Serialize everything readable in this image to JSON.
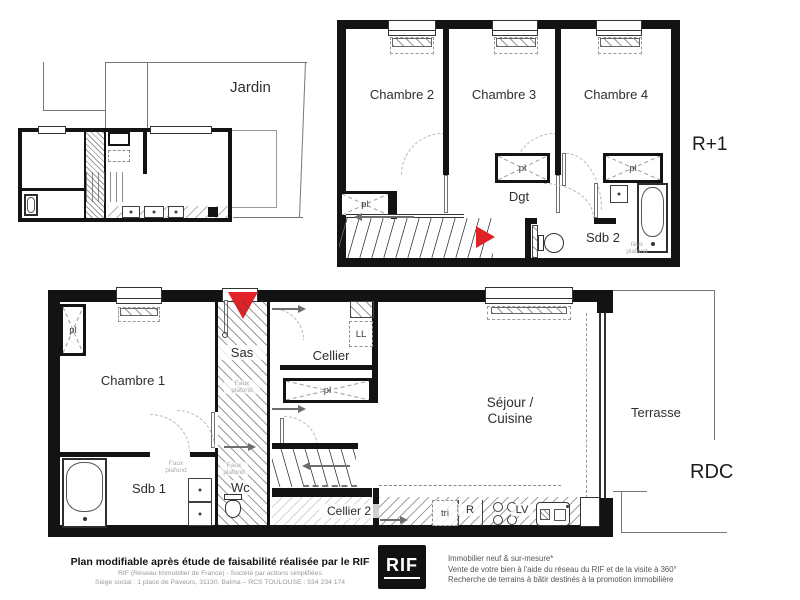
{
  "site": {
    "jardin": "Jardin"
  },
  "r1": {
    "level": "R+1",
    "chambre2": "Chambre 2",
    "chambre3": "Chambre 3",
    "chambre4": "Chambre 4",
    "dgt": "Dgt",
    "sdb2": "Sdb 2",
    "pl": "pl",
    "faux": "faux",
    "plafond": "plafond"
  },
  "rdc": {
    "level": "RDC",
    "chambre1": "Chambre 1",
    "sas": "Sas",
    "cellier": "Cellier",
    "ll": "LL",
    "pl": "pl",
    "sejour_line1": "Séjour /",
    "sejour_line2": "Cuisine",
    "terrasse": "Terrasse",
    "sdb1": "Sdb 1",
    "wc": "Wc",
    "cellier2": "Cellier 2",
    "tri": "tri",
    "fridge": "R",
    "lv": "LV",
    "faux": "Faux",
    "plafond": "plafond"
  },
  "footer": {
    "disclaimer": "Plan modifiable après étude de faisabilité réalisée par le RIF",
    "company_line": "RIF (Réseau Immobilier de France)  -  Société par actions simplifiées",
    "address_line": "Siège social : 1 place de Paveurs, 31130, Balma – RCS TOULOUSE : 534 234 174",
    "logo": "RIF",
    "services": [
      "Immobilier neuf & sur-mesure*",
      "Vente de votre bien à l'aide du réseau du RIF et de la visite à 360°",
      "Recherche de terrains à bâtir destinés à la promotion immobilière"
    ]
  },
  "colors": {
    "accent_red": "#e32227",
    "wall_black": "#131313",
    "label_gray": "#2e2e2e",
    "faint_gray": "#ababab"
  }
}
